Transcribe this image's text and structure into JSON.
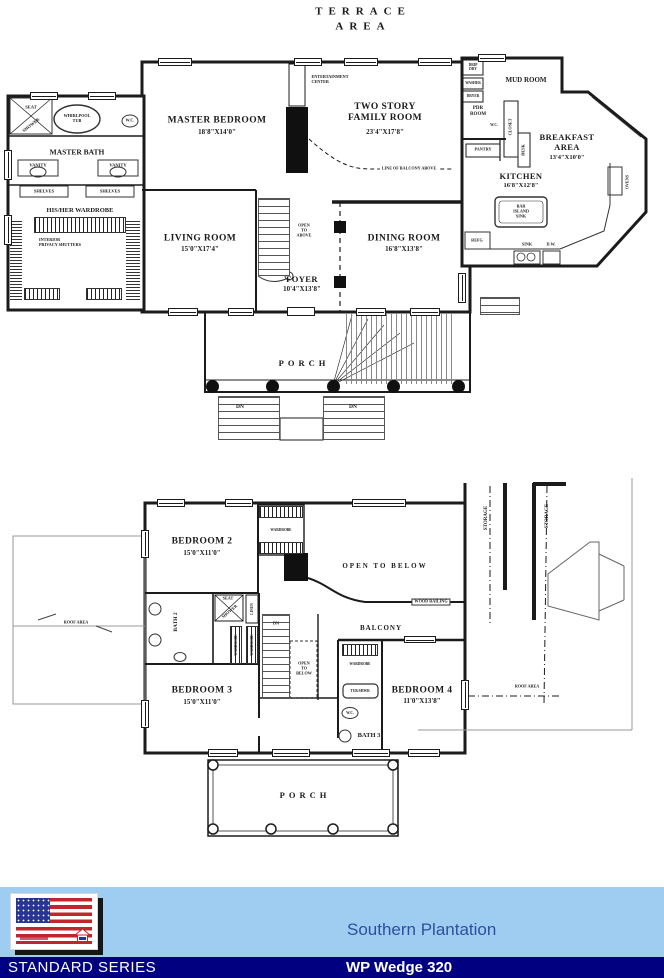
{
  "sheet": {
    "terrace_line1": "TERRACE",
    "terrace_line2": "AREA"
  },
  "floor1": {
    "master_bedroom_name": "MASTER BEDROOM",
    "master_bedroom_dims": "18'8\"X14'0\"",
    "family_room_name": "TWO STORY\nFAMILY ROOM",
    "family_room_dims": "23'4\"X17'8\"",
    "entertainment_center": "ENTERTAINMENT\nCENTER",
    "line_of_balcony": "LINE OF BALCONY ABOVE",
    "living_room_name": "LIVING ROOM",
    "living_room_dims": "15'0\"X17'4\"",
    "dining_room_name": "DINING ROOM",
    "dining_room_dims": "16'8\"X13'8\"",
    "foyer_name": "FOYER",
    "foyer_dims": "10'4\"X13'8\"",
    "open_to_above": "OPEN\nTO\nABOVE",
    "porch": "PORCH",
    "dn": "DN",
    "master_bath": "MASTER BATH",
    "seat": "SEAT",
    "shower": "SHOWER",
    "whirlpool_tub": "WHIRLPOOL\nTUB",
    "wc": "W.C.",
    "vanity": "VANITY",
    "shelves": "SHELVES",
    "his_her_wardrobe": "HIS/HER WARDROBE",
    "privacy_shutters": "INTERIOR\nPRIVACY SHUTTERS",
    "mud_room": "MUD ROOM",
    "drip_dry": "DRIP\nDRY",
    "washer": "WASHER",
    "dryer": "DRYER",
    "pdr_room": "PDR\nROOM",
    "closet": "CLOSET",
    "pantry": "PANTRY",
    "desk": "DESK",
    "breakfast_name": "BREAKFAST\nAREA",
    "breakfast_dims": "13'4\"X10'0\"",
    "kitchen_name": "KITCHEN",
    "kitchen_dims": "16'8\"X12'8\"",
    "island": "BAR\nISLAND\nSINK",
    "refg": "REFG",
    "sink": "SINK",
    "dw": "D.W.",
    "ovens": "OVENS"
  },
  "floor2": {
    "bedroom2_name": "BEDROOM 2",
    "bedroom2_dims": "15'0\"X11'0\"",
    "bedroom3_name": "BEDROOM 3",
    "bedroom3_dims": "15'0\"X11'0\"",
    "bedroom4_name": "BEDROOM 4",
    "bedroom4_dims": "11'0\"X13'8\"",
    "open_to_below": "OPEN TO BELOW",
    "open_to_below_stair": "OPEN\nTO\nBELOW",
    "wood_railing": "WOOD RAILING",
    "balcony": "BALCONY",
    "wardrobe": "WARDROBE",
    "bath2": "BATH 2",
    "bath3": "BATH 3",
    "seat": "SEAT",
    "shower": "SHOWER",
    "linen": "LINEN",
    "tub_shwr": "TUB/SHWR",
    "wc": "W.C.",
    "dn": "DN",
    "storage": "STORAGE",
    "roof_area": "ROOF AREA",
    "porch": "PORCH"
  },
  "footer": {
    "plan_name": "Southern Plantation",
    "series_label": "STANDARD SERIES",
    "model_label": "WP Wedge 320",
    "colors": {
      "band": "#9fcdf2",
      "bar": "#000080",
      "plan_name_text": "#2f4ea0",
      "flag_red": "#c0272d",
      "flag_blue": "#283593"
    }
  }
}
